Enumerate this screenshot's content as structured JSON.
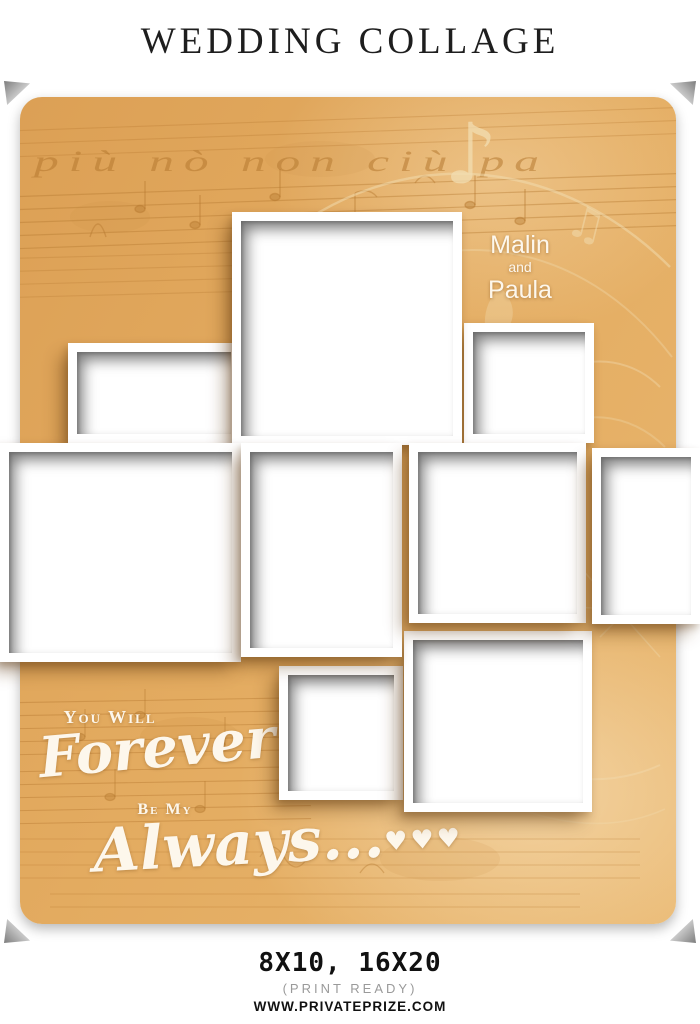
{
  "header": {
    "title": "WEDDING COLLAGE"
  },
  "collage": {
    "couple": {
      "name1": "Malin",
      "conjunction": "and",
      "name2": "Paula"
    },
    "quote": {
      "pre": "You Will",
      "word1": "Forever",
      "mid": "Be My",
      "word2": "Always...",
      "hearts": "♥♥♥"
    },
    "background_script": "più nò  non ciù  pa",
    "photo_slots": 9,
    "colors": {
      "card_background": "#e3ab60",
      "texture_ink": "#b5782f",
      "texture_cream": "#f2ddb2",
      "text_white": "#fdf7ec"
    }
  },
  "footer": {
    "sizes": "8X10, 16X20",
    "note": "(PRINT READY)",
    "website": "WWW.PRIVATEPRIZE.COM"
  }
}
